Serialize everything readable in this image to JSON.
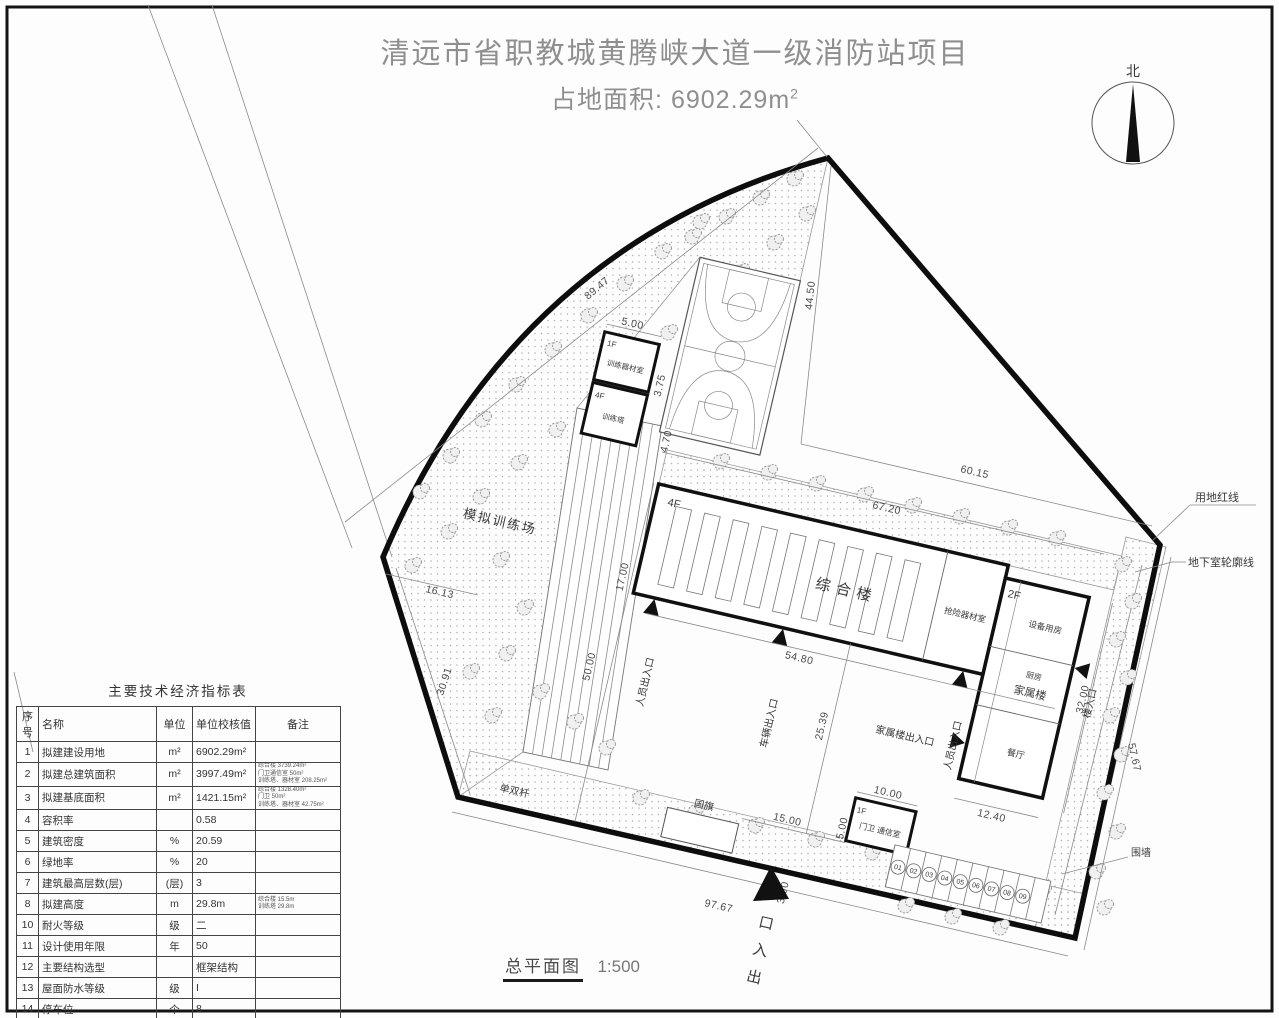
{
  "title": {
    "line1": "清远市省职教城黄腾峡大道一级消防站项目",
    "area_label": "占地面积:",
    "area_value": "6902.29m",
    "area_sup": "2"
  },
  "compass": {
    "north_label": "北"
  },
  "footer": {
    "name": "总平面图",
    "scale": "1:500"
  },
  "table": {
    "title": "主要技术经济指标表",
    "headers": [
      "序号",
      "名称",
      "单位",
      "单位校核值",
      "备注"
    ],
    "rows": [
      {
        "no": "1",
        "name": "拟建建设用地",
        "unit": "m²",
        "value": "6902.29m²",
        "note": ""
      },
      {
        "no": "2",
        "name": "拟建总建筑面积",
        "unit": "m²",
        "value": "3997.49m²",
        "note": "综合楼 3739.24m²\n门卫通信室 50m²\n训练塔、器材室 208.25m²"
      },
      {
        "no": "3",
        "name": "拟建基底面积",
        "unit": "m²",
        "value": "1421.15m²",
        "note": "综合楼 1328.40m²\n门卫 50m²\n训练塔、器材室 42.75m²"
      },
      {
        "no": "4",
        "name": "容积率",
        "unit": "",
        "value": "0.58",
        "note": ""
      },
      {
        "no": "5",
        "name": "建筑密度",
        "unit": "%",
        "value": "20.59",
        "note": ""
      },
      {
        "no": "6",
        "name": "绿地率",
        "unit": "%",
        "value": "20",
        "note": ""
      },
      {
        "no": "7",
        "name": "建筑最高层数(层)",
        "unit": "(层)",
        "value": "3",
        "note": ""
      },
      {
        "no": "8",
        "name": "拟建高度",
        "unit": "m",
        "value": "29.8m",
        "note": "综合楼 15.5m\n训练塔 29.8m"
      },
      {
        "no": "10",
        "name": "耐火等级",
        "unit": "级",
        "value": "二",
        "note": ""
      },
      {
        "no": "11",
        "name": "设计使用年限",
        "unit": "年",
        "value": "50",
        "note": ""
      },
      {
        "no": "12",
        "name": "主要结构选型",
        "unit": "",
        "value": "框架结构",
        "note": ""
      },
      {
        "no": "13",
        "name": "屋面防水等级",
        "unit": "级",
        "value": "I",
        "note": ""
      },
      {
        "no": "14",
        "name": "停车位",
        "unit": "个",
        "value": "8",
        "note": ""
      }
    ]
  },
  "plan": {
    "labels": {
      "training_field": "模拟训练场",
      "bars": "单双杆",
      "flag": "国旗",
      "red_line": "用地红线",
      "basement_line": "地下室轮廓线",
      "wall": "围墙"
    },
    "buildings": {
      "main_floor": "4F",
      "main_name": "综合楼",
      "rescue_room": "抢险器材室",
      "family_floor": "2F",
      "equipment_room": "设备用房",
      "kitchen": "厨房",
      "family_name": "家属楼",
      "dining": "餐厅",
      "gate_floor": "1F",
      "gate_name": "门卫 通信室",
      "tower1_floor": "1F",
      "tower1_name": "训练器材室",
      "tower2_floor": "4F",
      "tower2_name": "训练塔"
    },
    "entrances": {
      "person_left": "人员出入口",
      "vehicle": "车辆出入口",
      "person_right": "人员出入口",
      "family_exit": "家属楼出入口",
      "building_entry": "楼入口",
      "main_gate": "出入口",
      "main_gate_chars": [
        "口",
        "入",
        "出"
      ]
    },
    "parking": [
      "01",
      "02",
      "03",
      "04",
      "05",
      "06",
      "07",
      "08",
      "09"
    ],
    "dims": {
      "d8947": "89.47",
      "d4450": "44.50",
      "d6015": "60.15",
      "d6720": "67.20",
      "d1700": "17.00",
      "d5000": "50.00",
      "d1613": "16.13",
      "d3091": "30.91",
      "d5480": "54.80",
      "d2539": "25.39",
      "d9767": "97.67",
      "d5767": "57.67",
      "d3200": "32.00",
      "d1240": "12.40",
      "d1000": "10.00",
      "d1500": "15.00",
      "d500a": "5.00",
      "d500b": "5.00",
      "d350": "3.50",
      "d375": "3.75",
      "d470": "4.70"
    }
  }
}
